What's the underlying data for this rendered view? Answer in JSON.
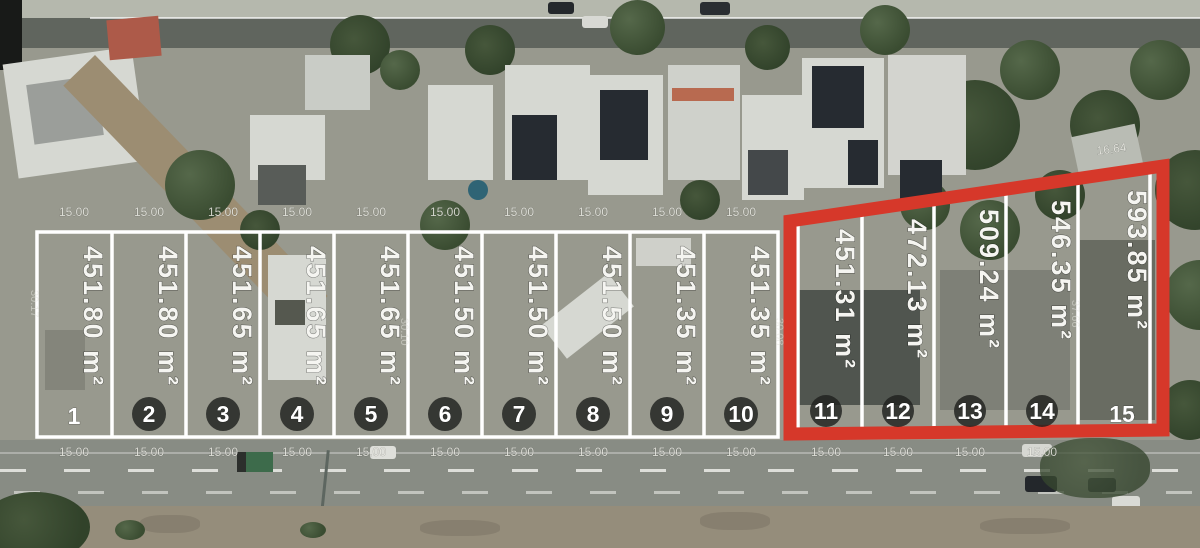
{
  "lots": [
    {
      "number": "1",
      "area": "451.80 m²"
    },
    {
      "number": "2",
      "area": "451.80 m²"
    },
    {
      "number": "3",
      "area": "451.65 m²"
    },
    {
      "number": "4",
      "area": "451.65 m²"
    },
    {
      "number": "5",
      "area": "451.65 m²"
    },
    {
      "number": "6",
      "area": "451.50 m²"
    },
    {
      "number": "7",
      "area": "451.50 m²"
    },
    {
      "number": "8",
      "area": "451.50 m²"
    },
    {
      "number": "9",
      "area": "451.35 m²"
    },
    {
      "number": "10",
      "area": "451.35 m²"
    },
    {
      "number": "11",
      "area": "451.31 m²"
    },
    {
      "number": "12",
      "area": "472.13 m²"
    },
    {
      "number": "13",
      "area": "509.24 m²"
    },
    {
      "number": "14",
      "area": "546.35 m²"
    },
    {
      "number": "15",
      "area": "593.85 m²"
    }
  ],
  "dimensions": {
    "frontage": "15.00",
    "top_right": "16.64",
    "side_left": "30.17",
    "side_mid": "30.10",
    "side_right": "30.08",
    "side_lot15": "37.66"
  },
  "colors": {
    "highlight": "#d6382a",
    "boundary": "#ffffff"
  }
}
